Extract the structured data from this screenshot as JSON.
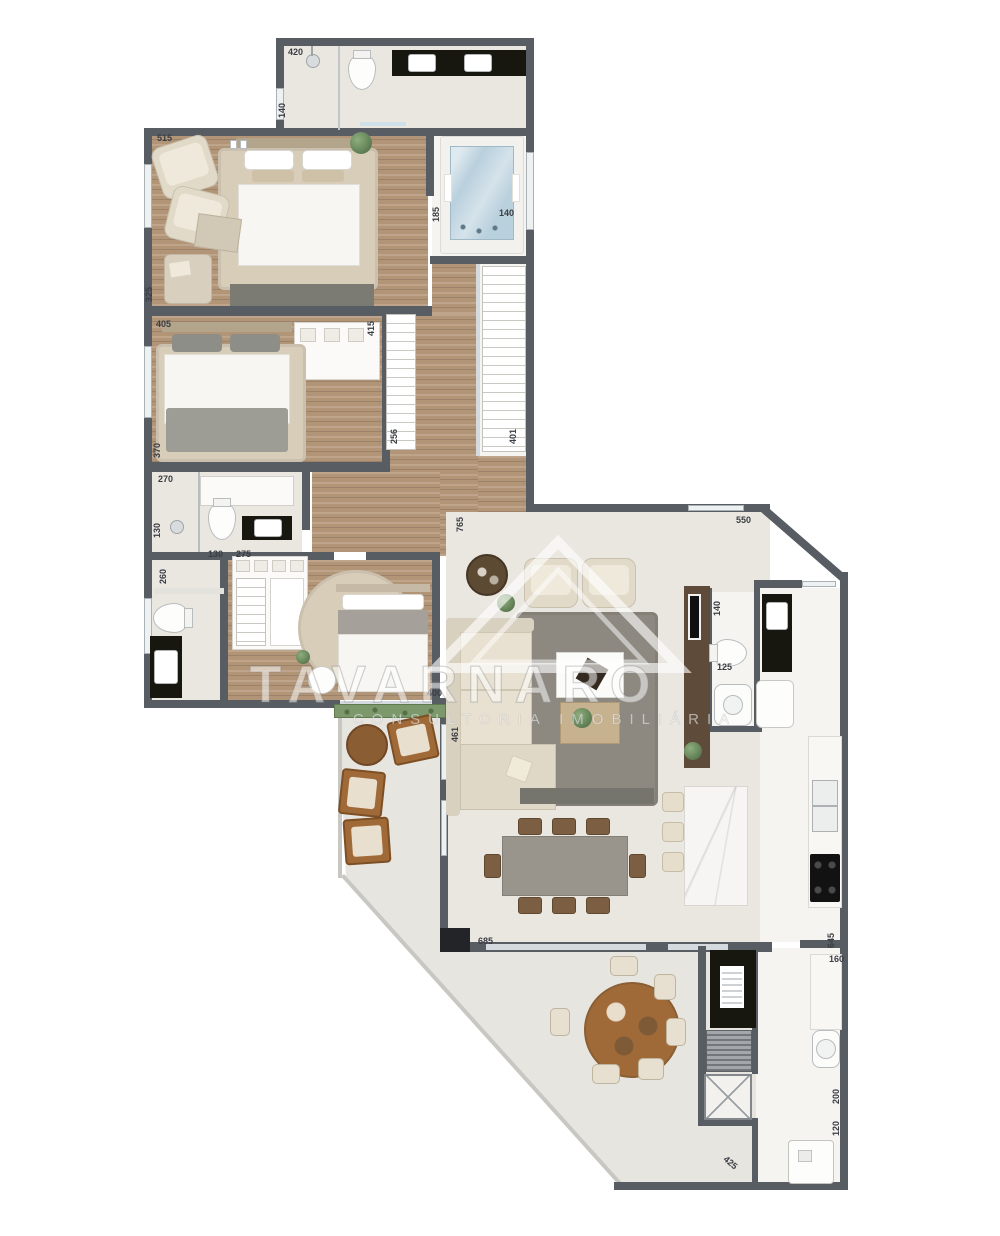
{
  "watermark": {
    "title": "TAVARNARO",
    "subtitle": "CONSULTORIA IMOBILIÁRIA"
  },
  "labels": [
    "420",
    "140",
    "515",
    "185",
    "140",
    "325",
    "405",
    "415",
    "256",
    "401",
    "370",
    "270",
    "130",
    "260",
    "130",
    "275",
    "400",
    "461",
    "765",
    "550",
    "140",
    "125",
    "685",
    "645",
    "160",
    "200",
    "120",
    "425"
  ],
  "colors": {
    "wall": "#585c63",
    "wallblack": "#232428",
    "floor": "#eae7e1",
    "floorwhite": "#f5f4f0",
    "terrace": "#e7e5e0",
    "water": "#b9d0dd",
    "black": "#17170f",
    "ruggray": "#8d8880",
    "rugbeige": "#d8cdb9",
    "sofa": "#e2dac9",
    "tablegray": "#9a958c",
    "chair": "#7c5f43",
    "twood": "#a06a38",
    "marble": "#f6f5f3",
    "panel": "#5f4b39",
    "glass": "#d4dade",
    "label": "#3a3d43"
  }
}
